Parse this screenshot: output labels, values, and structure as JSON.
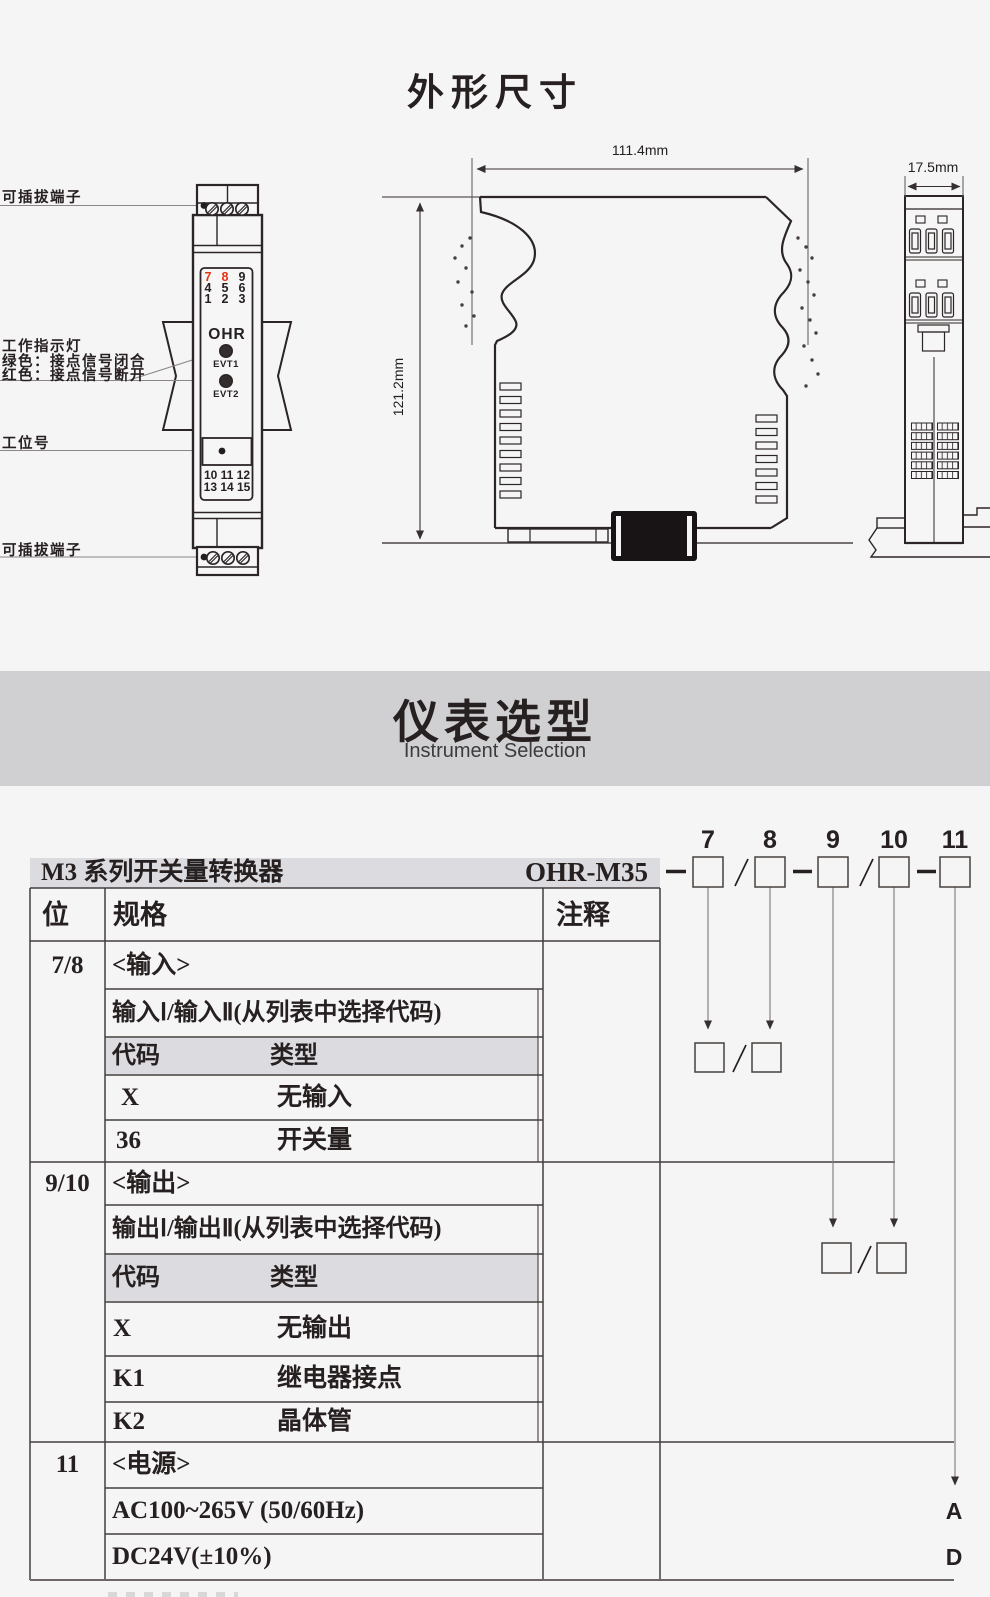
{
  "dimension_drawing": {
    "title": "外形尺寸",
    "callouts": {
      "terminal_top": "可插拔端子",
      "indicator_line1": "工作指示灯",
      "indicator_line2": "绿色：接点信号闭合",
      "indicator_line3": "红色：接点信号断开",
      "tag_label": "工位号",
      "terminal_bottom": "可插拔端子"
    },
    "front_view": {
      "terminal_digits_top": [
        [
          "7",
          "8",
          "9"
        ],
        [
          "4",
          "5",
          "6"
        ],
        [
          "1",
          "2",
          "3"
        ]
      ],
      "brand": "OHR",
      "led1_label": "EVT1",
      "led2_label": "EVT2",
      "terminal_digits_bottom": [
        "10 11 12",
        "13 14 15"
      ]
    },
    "dims": {
      "width": "111.4mm",
      "height": "121.2mm",
      "depth": "17.5mm"
    }
  },
  "selection": {
    "band_title": "仪表选型",
    "band_subtitle": "Instrument Selection",
    "series_title": "M3 系列开关量转换器",
    "model_prefix": "OHR-M35",
    "digit_labels": [
      "7",
      "8",
      "9",
      "10",
      "11"
    ],
    "table": {
      "col_position": "位",
      "col_spec": "规格",
      "col_note": "注释",
      "input_section": {
        "position": "7/8",
        "heading": "<输入>",
        "subheading": "输入Ⅰ/输入Ⅱ(从列表中选择代码)",
        "code_header": "代码",
        "type_header": "类型",
        "rows": [
          {
            "code": "X",
            "type": "无输入"
          },
          {
            "code": "36",
            "type": "开关量"
          }
        ]
      },
      "output_section": {
        "position": "9/10",
        "heading": "<输出>",
        "subheading": "输出Ⅰ/输出Ⅱ(从列表中选择代码)",
        "code_header": "代码",
        "type_header": "类型",
        "rows": [
          {
            "code": "X",
            "type": "无输出"
          },
          {
            "code": "K1",
            "type": "继电器接点"
          },
          {
            "code": "K2",
            "type": "晶体管"
          }
        ]
      },
      "power_section": {
        "position": "11",
        "heading": "<电源>",
        "rows": [
          {
            "spec": "AC100~265V (50/60Hz)",
            "code": "A"
          },
          {
            "spec": "DC24V(±10%)",
            "code": "D"
          }
        ]
      }
    }
  },
  "colors": {
    "accent_red": "#e63312",
    "band_gray": "#d0cfd2",
    "row_gray": "#dcdbdf",
    "page_bg": "#f6f5f6",
    "line_dark": "#2b2526"
  }
}
